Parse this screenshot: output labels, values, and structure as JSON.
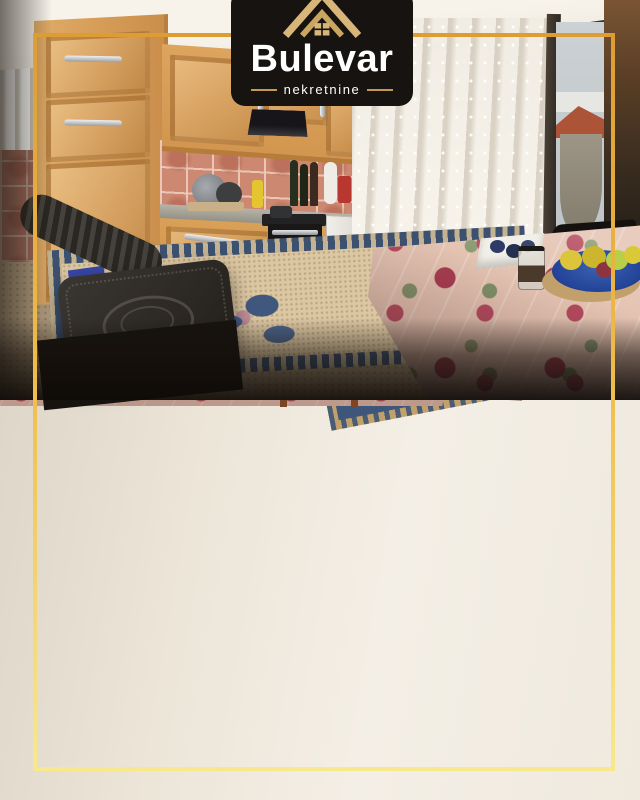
{
  "page": {
    "width": 640,
    "height": 800,
    "background": "#111111"
  },
  "brand": {
    "name": "Bulevar",
    "subtitle": "nekretnine",
    "logo_background": "#161310",
    "text_color": "#ffffff",
    "accent_gold": "#d3af72"
  },
  "frame": {
    "color_top": "#dd9d33",
    "color_bottom": "#f8e88d",
    "inset_px": 33,
    "thickness_px": 4
  },
  "photos": [
    {
      "id": "living-room-photo",
      "description": "Living room with flat-screen TV on a dark wooden sideboard, single bed with orange checkered cover, dining table with floral tablecloth, blue fruit bowl with apples, bowl of dyed eggs, open balcony door with sheer curtain, framed landscape painting, baby wall calendar, open wooden door with metal handle, herringbone parquet floor and blue rug"
    },
    {
      "id": "kitchen-photo",
      "description": "Kitchen with light oak cabinets, black extractor hood, oven with cooktop, terracotta tile backsplash, small white fridge, wood-burning stove with corrugated flue pipe, beige rug with blue border, table with floral tablecloth, plate of fruit and jar, balcony window with sheer curtains and red railing outside"
    }
  ]
}
